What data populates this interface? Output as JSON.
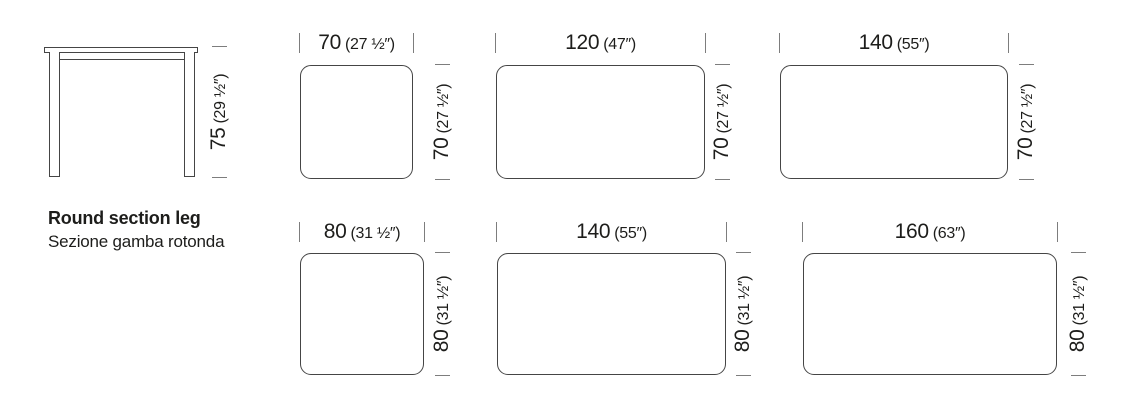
{
  "diagram": {
    "title_hint": "table dimensions drawing",
    "side_view": {
      "height_value": "75",
      "height_paren": "(29 ½″)",
      "caption_en": "Round section leg",
      "caption_it": "Sezione gamba rotonda"
    },
    "tops": [
      {
        "name": "70x70",
        "width_value": "70",
        "width_paren": "(27 ½″)",
        "depth_value": "70",
        "depth_paren": "(27 ½″)"
      },
      {
        "name": "120x70",
        "width_value": "120",
        "width_paren": "(47″)",
        "depth_value": "70",
        "depth_paren": "(27 ½″)"
      },
      {
        "name": "140x70",
        "width_value": "140",
        "width_paren": "(55″)",
        "depth_value": "70",
        "depth_paren": "(27 ½″)"
      },
      {
        "name": "80x80",
        "width_value": "80",
        "width_paren": "(31 ½″)",
        "depth_value": "80",
        "depth_paren": "(31 ½″)"
      },
      {
        "name": "140x80",
        "width_value": "140",
        "width_paren": "(55″)",
        "depth_value": "80",
        "depth_paren": "(31 ½″)"
      },
      {
        "name": "160x80",
        "width_value": "160",
        "width_paren": "(63″)",
        "depth_value": "80",
        "depth_paren": "(31 ½″)"
      }
    ],
    "colors": {
      "line": "#454545",
      "tick": "#7d7d7d",
      "text": "#1d1d1b",
      "background": "#ffffff"
    }
  }
}
